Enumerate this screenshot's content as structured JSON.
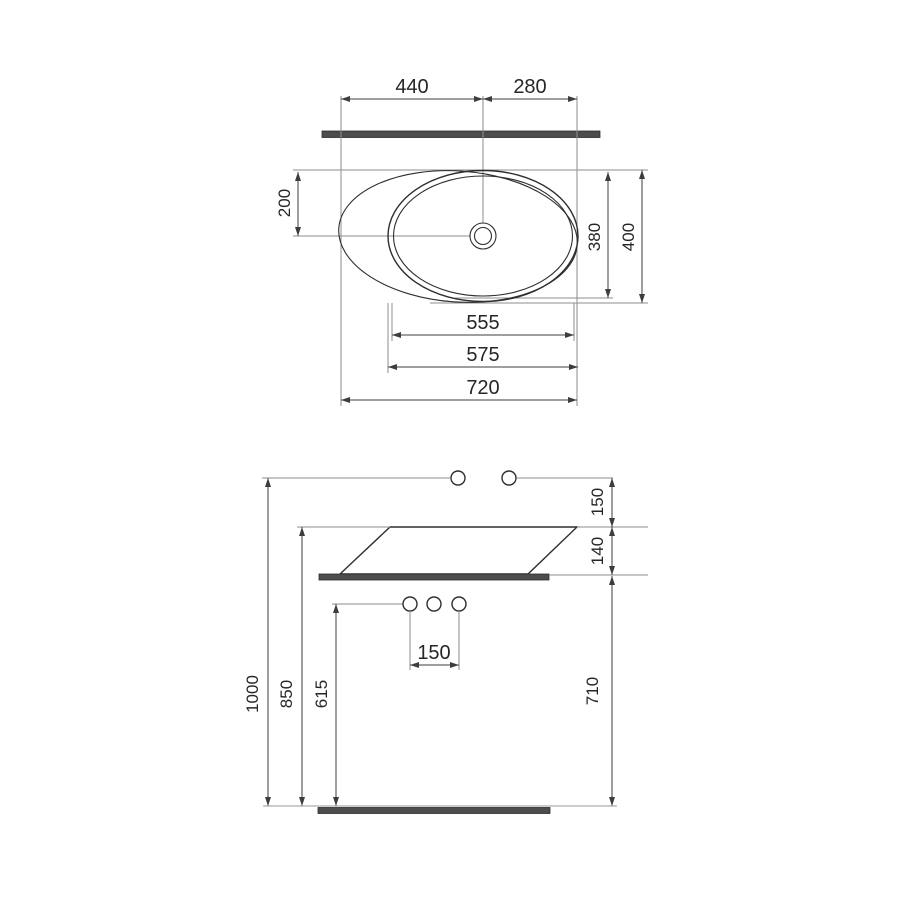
{
  "drawing": {
    "kind": "sink technical dimension drawing",
    "plan_view": {
      "dims": {
        "center_offset_left": "440",
        "center_offset_right": "280",
        "drain_from_front_edge": "200",
        "basin_depth": "380",
        "overall_depth": "400",
        "inner_width": "555",
        "basin_width": "575",
        "overall_width": "720"
      }
    },
    "front_view": {
      "dims": {
        "tap_above_rim": "150",
        "basin_height": "140",
        "tap_hole_pitch": "150",
        "tap_height_from_floor": "1000",
        "rim_height_from_floor": "850",
        "outlet_height_from_floor": "615",
        "counter_height_from_floor": "710"
      }
    },
    "colors": {
      "background": "#ffffff",
      "outline": "#2e2e2e",
      "dimension_line": "#3d3d3d",
      "extension_line": "#8e8e8e",
      "slab_fill": "#4d4d4d",
      "floor_line": "#9a9a9a"
    }
  }
}
